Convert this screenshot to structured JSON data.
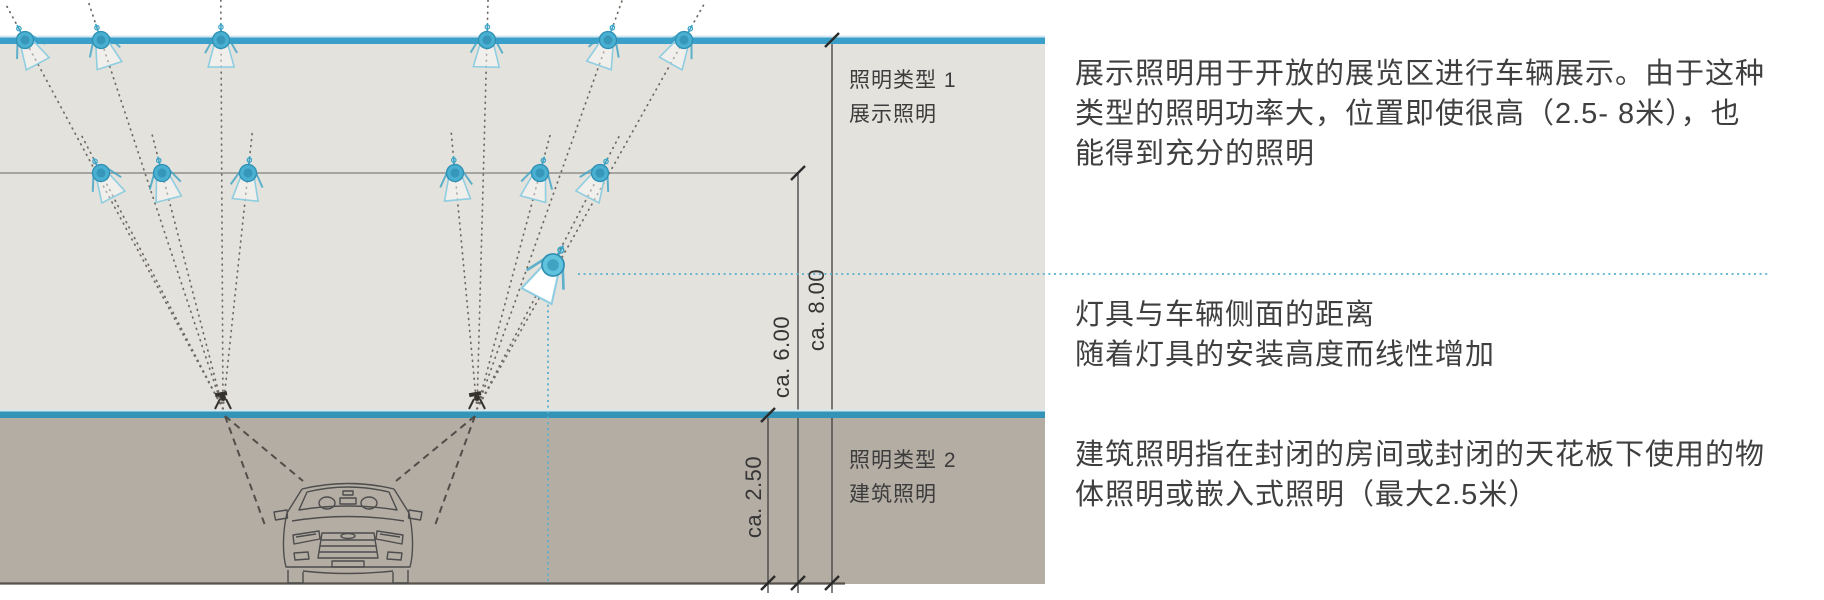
{
  "colors": {
    "accent_blue": "#3a9fc9",
    "accent_blue_lower": "#3494b8",
    "zone1_bg": "#e4e2dc",
    "zone2_bg": "#b4ada4",
    "beam_gray": "#6e6a64",
    "spot_cyan": "#3ba3c6",
    "dotted_blue": "#58b0cf",
    "text_dark": "#3f3f3f"
  },
  "diagram": {
    "zone1": {
      "label": "照明类型 1\n展示照明"
    },
    "zone2": {
      "label": "照明类型 2\n建筑照明"
    },
    "dimensions": {
      "height_8m": "ca. 8.00",
      "height_6m": "ca. 6.00",
      "height_2_5m": "ca. 2.50"
    }
  },
  "annotations": {
    "display_lighting": "展示照明用于开放的展览区进行车辆展示。由于这种\n类型的照明功率大，位置即使很高（2.5- 8米），也\n能得到充分的照明",
    "fixture_distance": "灯具与车辆侧面的距离\n随着灯具的安装高度而线性增加",
    "architectural_lighting": "建筑照明指在封闭的房间或封闭的天花板下使用的物\n体照明或嵌入式照明（最大2.5米）"
  }
}
